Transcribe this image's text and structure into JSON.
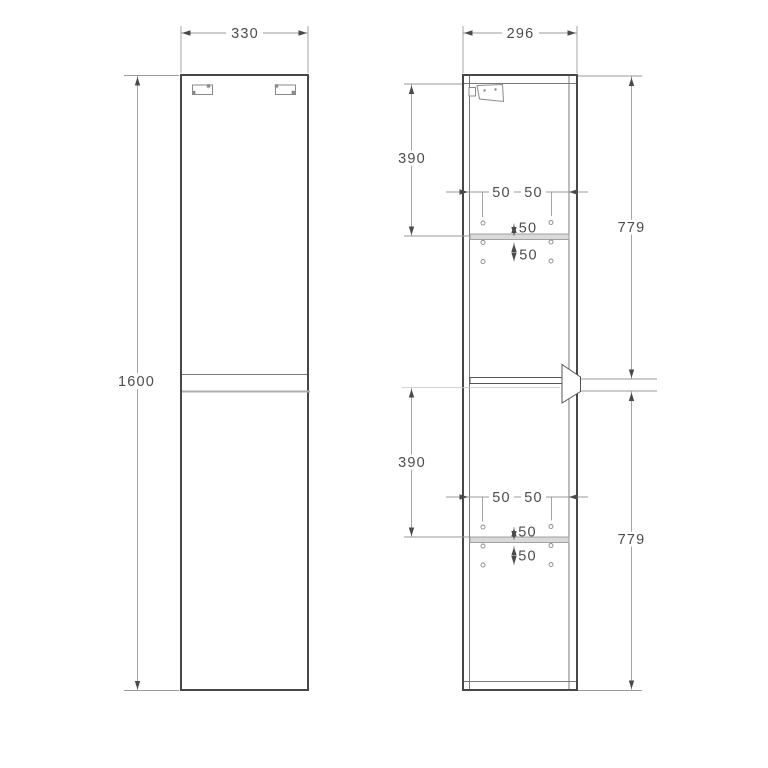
{
  "drawing_title": "tall-cabinet-dimension-drawing",
  "front_view": {
    "width": "330",
    "height": "1600"
  },
  "side_view": {
    "depth": "296",
    "upper_section": "390",
    "lower_section": "390",
    "upper_door": "779",
    "lower_door": "779",
    "upper_holes": {
      "from_front": "50",
      "from_back": "50",
      "above_shelf": "50",
      "below_shelf": "50"
    },
    "lower_holes": {
      "from_front": "50",
      "from_back": "50",
      "above_shelf": "50",
      "below_shelf": "50"
    }
  }
}
